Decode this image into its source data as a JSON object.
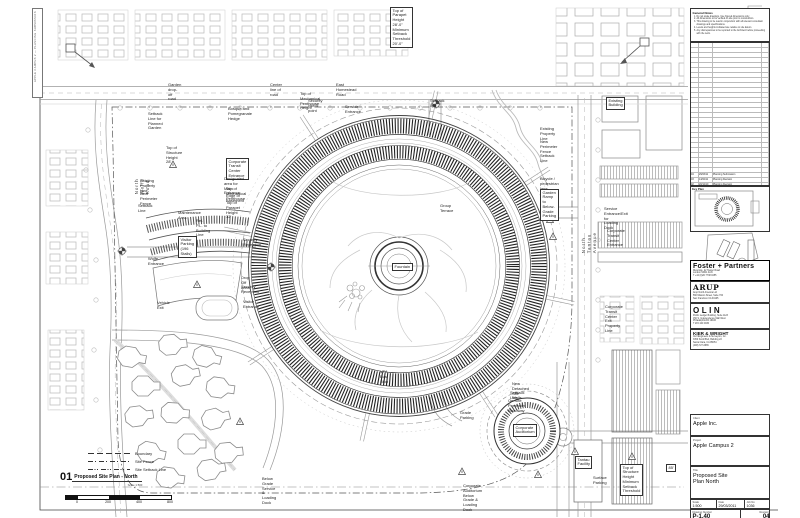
{
  "sheet": {
    "edge_text": "APPLE CAMPUS 2 — PLANNING SUBMISSION",
    "plan_title": {
      "num": "01",
      "text": "Proposed Site Plan - North",
      "sub": "Scale 1:500"
    },
    "scalebar_labels": [
      "0",
      "200",
      "400",
      "800"
    ]
  },
  "legend": {
    "items": [
      {
        "label": "Boundary",
        "style": "boundary"
      },
      {
        "label": "Site Fence",
        "style": "fence"
      },
      {
        "label": "Site Setback Line",
        "style": "setback"
      }
    ]
  },
  "annotations": [
    {
      "x": 390,
      "y": 7,
      "t": "Top of Parapet Height 28'-0\"\nMinimum Setback Threshold 20'-0\"",
      "s": "b"
    },
    {
      "x": 168,
      "y": 83,
      "t": "Garden drop-off road"
    },
    {
      "x": 270,
      "y": 83,
      "t": "Center line of road"
    },
    {
      "x": 336,
      "y": 83,
      "t": "East Homestead Road"
    },
    {
      "x": 300,
      "y": 92,
      "t": "Top of Mechanical Penthouse Height"
    },
    {
      "x": 308,
      "y": 99,
      "t": "Security check point"
    },
    {
      "x": 345,
      "y": 105,
      "t": "Service Entrance"
    },
    {
      "x": 430,
      "y": 99,
      "t": "Setback line"
    },
    {
      "x": 148,
      "y": 112,
      "t": "Setback Line for Planned\nGarden"
    },
    {
      "x": 228,
      "y": 107,
      "t": "Bosque and Pomegranate Hedge"
    },
    {
      "x": 166,
      "y": 146,
      "t": "Top of Structure Height 28'"
    },
    {
      "x": 140,
      "y": 179,
      "t": "Existing Property Line"
    },
    {
      "x": 140,
      "y": 192,
      "t": "New Perimeter Fence"
    },
    {
      "x": 138,
      "y": 204,
      "t": "Setback Line"
    },
    {
      "x": 178,
      "y": 211,
      "t": "Maintenance Area"
    },
    {
      "x": 196,
      "y": 219,
      "t": "Rel. P.L. to Building Line"
    },
    {
      "x": 226,
      "y": 158,
      "t": "Corporate Transit\nCenter Entrance",
      "s": "b"
    },
    {
      "x": 224,
      "y": 177,
      "t": "Designated area for Main\nEntrance"
    },
    {
      "x": 226,
      "y": 187,
      "t": "Top of Mechanical Penthouse"
    },
    {
      "x": 226,
      "y": 194,
      "t": "Edge of Basement"
    },
    {
      "x": 226,
      "y": 201,
      "t": "Top of Parapet Height 32'"
    },
    {
      "x": 178,
      "y": 236,
      "t": "Visitor Parking\n(196 Stalls)",
      "s": "b"
    },
    {
      "x": 148,
      "y": 257,
      "t": "Wolfe Entrance"
    },
    {
      "x": 157,
      "y": 301,
      "t": "Vehicle Exit"
    },
    {
      "x": 243,
      "y": 238,
      "t": "Security\nReception"
    },
    {
      "x": 241,
      "y": 276,
      "t": "Drop Off Area"
    },
    {
      "x": 241,
      "y": 285,
      "t": "Security Reception"
    },
    {
      "x": 243,
      "y": 300,
      "t": "Visitor Entrance"
    },
    {
      "x": 440,
      "y": 204,
      "t": "Group Terrace"
    },
    {
      "x": 392,
      "y": 263,
      "t": "Fountain",
      "s": "b"
    },
    {
      "x": 540,
      "y": 127,
      "t": "Existing Property Line"
    },
    {
      "x": 540,
      "y": 140,
      "t": "New Perimeter Fence"
    },
    {
      "x": 540,
      "y": 154,
      "t": "Setback Line"
    },
    {
      "x": 540,
      "y": 177,
      "t": "Bicycle / pedestrian lane"
    },
    {
      "x": 540,
      "y": 189,
      "t": "Garden Ramp to\nBelow-Grade Parking",
      "s": "b"
    },
    {
      "x": 604,
      "y": 207,
      "t": "Service Entrance/Exit for\nLoading Dock"
    },
    {
      "x": 607,
      "y": 229,
      "t": "Corporate Transit Center Entrance"
    },
    {
      "x": 605,
      "y": 305,
      "t": "Corporate Transit Center Exit\nProperty Line"
    },
    {
      "x": 606,
      "y": 97,
      "t": "Existing Building",
      "s": "b"
    },
    {
      "x": 512,
      "y": 382,
      "t": "New Detached Site Walls"
    },
    {
      "x": 510,
      "y": 391,
      "t": "Setback Line"
    },
    {
      "x": 508,
      "y": 399,
      "t": "On-Site Perimeter\nRoadway"
    },
    {
      "x": 513,
      "y": 424,
      "t": "Corporate\nAuditorium",
      "s": "b"
    },
    {
      "x": 460,
      "y": 411,
      "t": "Grade Parking"
    },
    {
      "x": 463,
      "y": 484,
      "t": "Corporate Auditorium Below\nGrade & Loading Dock"
    },
    {
      "x": 575,
      "y": 456,
      "t": "Tantau\nFacility",
      "s": "b"
    },
    {
      "x": 593,
      "y": 476,
      "t": "Surface Parking"
    },
    {
      "x": 620,
      "y": 464,
      "t": "Top of Structure Height\nMinimum Setback Threshold",
      "s": "b"
    },
    {
      "x": 666,
      "y": 464,
      "t": "85'",
      "s": "b"
    },
    {
      "x": 262,
      "y": 477,
      "t": "Below Grade Service &\nLoading Dock"
    },
    {
      "x": 380,
      "y": 370,
      "t": "VTA Bus Stop"
    },
    {
      "x": 134,
      "y": 178,
      "t": "North Wolfe Road",
      "s": "v"
    },
    {
      "x": 581,
      "y": 232,
      "t": "North Tantau Avenue",
      "s": "v"
    }
  ],
  "titleblock": {
    "notes": {
      "title": "General Notes",
      "items": [
        "Do not scale drawings. Use figured dimensions only.",
        "All dimensions to be verified on site prior to construction.",
        "This drawing to be read in conjunction with all relevant consultant drawings and specifications.",
        "Levels and heights indicated are relative to site datum.",
        "Any discrepancies to be reported to the Architect before proceeding with the work."
      ]
    },
    "revisions": {
      "header": [
        "Rev",
        "Date",
        "Revision / Issue",
        "Chk"
      ],
      "empty_rows": 26,
      "rows": [
        [
          "04",
          "29/03/11",
          "Planning Submission",
          ""
        ],
        [
          "03",
          "14/02/11",
          "Planning Revision",
          ""
        ],
        [
          "02",
          "20/12/10",
          "Planning Revision",
          ""
        ],
        [
          "01",
          "15/11/10",
          "Planning Revision",
          ""
        ],
        [
          "00",
          "01/10/10",
          "First Issue",
          ""
        ]
      ]
    },
    "keyplan_label": "Key Plan",
    "consultants": [
      {
        "name": "Foster + Partners",
        "style": "foster",
        "lines": [
          "Riverside, 22 Hester Road",
          "London SW11 4AN",
          "T +44 (0)20 7738 0455"
        ]
      },
      {
        "name": "ARUP",
        "style": "arup",
        "lines": [
          "Arup North America Ltd",
          "560 Mission Street, Suite 700",
          "San Francisco CA 94105"
        ]
      },
      {
        "name": "OLIN",
        "style": "olin",
        "lines": [
          "Public Ledger Building, Suite 1123",
          "150 S. Independence Mall West",
          "Philadelphia PA 19106",
          "T 215 440 0030"
        ]
      },
      {
        "name": "KIER & WRIGHT",
        "style": "kier",
        "lines": [
          "Civil Engineers & Surveyors, Inc.",
          "3350 Scott Blvd, Building 22",
          "Santa Clara, CA 95054",
          "(408) 727-6665"
        ]
      }
    ],
    "client": {
      "label": "Client",
      "value": "Apple Inc."
    },
    "project": {
      "label": "Project",
      "value": "Apple Campus 2"
    },
    "title": {
      "label": "Title",
      "value": "Proposed Site Plan North"
    },
    "fields": {
      "scale_label": "Scale",
      "scale": "1:500",
      "date_label": "Date",
      "date": "29/03/2011",
      "job_label": "Job No",
      "job": "1036",
      "number_label": "Drawing Number",
      "number": "P-1.40",
      "rev_label": "Revision",
      "rev": "04"
    }
  }
}
